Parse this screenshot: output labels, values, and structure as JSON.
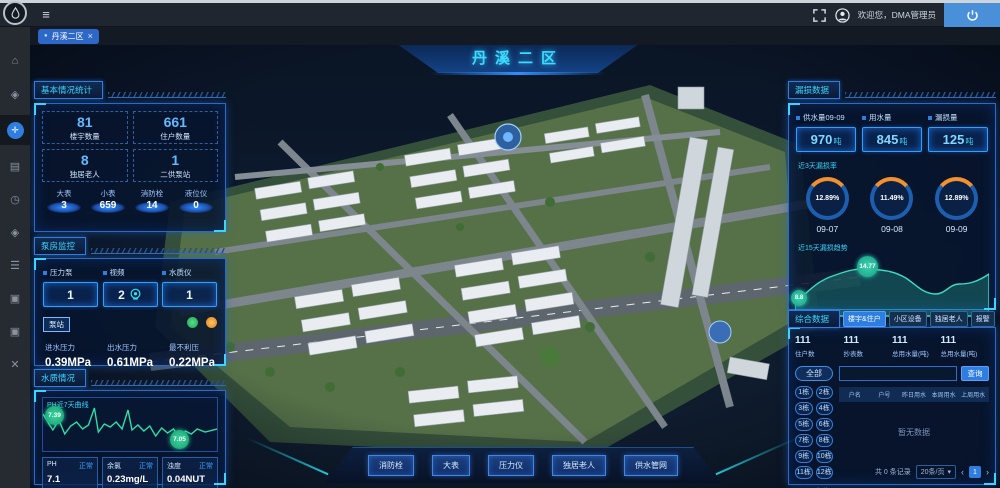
{
  "topbar": {
    "welcome": "欢迎您，DMA管理员",
    "hamburger_glyph": "≡"
  },
  "tab": {
    "dot": "●",
    "label": "丹溪二区",
    "close": "×"
  },
  "sidebar": {
    "icons": [
      {
        "name": "home",
        "glyph": "⌂"
      },
      {
        "name": "water-drop",
        "glyph": "◈"
      },
      {
        "name": "dashboard-active",
        "glyph": "✛"
      },
      {
        "name": "chart",
        "glyph": "▤"
      },
      {
        "name": "history-clock",
        "glyph": "◷"
      },
      {
        "name": "water-quality",
        "glyph": "◈"
      },
      {
        "name": "list",
        "glyph": "☰"
      },
      {
        "name": "monitor",
        "glyph": "▣"
      },
      {
        "name": "screen",
        "glyph": "▣"
      },
      {
        "name": "tools",
        "glyph": "✕"
      }
    ]
  },
  "main": {
    "title": "丹溪二区"
  },
  "stats_panel": {
    "title": "基本情况统计",
    "cells": [
      {
        "value": "81",
        "label": "楼宇数量"
      },
      {
        "value": "661",
        "label": "住户数量"
      },
      {
        "value": "8",
        "label": "独居老人"
      },
      {
        "value": "1",
        "label": "二供泵站"
      }
    ],
    "pedestals": [
      {
        "label": "大表",
        "value": "3"
      },
      {
        "label": "小表",
        "value": "659"
      },
      {
        "label": "消防栓",
        "value": "14"
      },
      {
        "label": "液位仪",
        "value": "0"
      }
    ]
  },
  "pump_panel": {
    "title": "泵房监控",
    "items": [
      {
        "label": "压力泵",
        "value": "1"
      },
      {
        "label": "视频",
        "value": "2"
      },
      {
        "label": "水质仪",
        "value": "1"
      }
    ],
    "station_tag": "泵站",
    "metrics": [
      {
        "label": "进水压力",
        "value": "0.39MPa"
      },
      {
        "label": "出水压力",
        "value": "0.61MPa"
      },
      {
        "label": "最不利压",
        "value": "0.22MPa"
      }
    ]
  },
  "quality_panel": {
    "title": "水质情况",
    "chart_title": "PH近7天曲线",
    "bubble_start": "7.39",
    "bubble_end": "7.05",
    "cards": [
      {
        "label": "PH",
        "status": "正常",
        "value": "7.1"
      },
      {
        "label": "余氯",
        "status": "正常",
        "value": "0.23mg/L"
      },
      {
        "label": "浊度",
        "status": "正常",
        "value": "0.04NUT"
      }
    ]
  },
  "leak_panel": {
    "title": "漏损数据",
    "stats": [
      {
        "label": "供水量09-09",
        "value": "970",
        "unit": "吨"
      },
      {
        "label": "用水量",
        "value": "845",
        "unit": "吨"
      },
      {
        "label": "漏损量",
        "value": "125",
        "unit": "吨"
      }
    ],
    "donut_title": "近3天漏损率",
    "donuts": [
      {
        "pct": "12.89%",
        "date": "09-07"
      },
      {
        "pct": "11.49%",
        "date": "09-08"
      },
      {
        "pct": "12.89%",
        "date": "09-09"
      }
    ],
    "trend_title": "近15天漏损趋势",
    "trend_bubble_start": "8.8",
    "trend_bubble_peak": "14.77"
  },
  "data_panel": {
    "title": "综合数据",
    "tabs": [
      {
        "label": "楼宇&住户"
      },
      {
        "label": "小区设备"
      },
      {
        "label": "独居老人"
      },
      {
        "label": "报警"
      }
    ],
    "stats": [
      {
        "value": "111",
        "label": "住户数"
      },
      {
        "value": "111",
        "label": "抄表数"
      },
      {
        "value": "111",
        "label": "总用水量(吨)"
      },
      {
        "value": "111",
        "label": "总用水量(吨)"
      }
    ],
    "all_button": "全部",
    "buildings": [
      "1栋",
      "2栋",
      "3栋",
      "4栋",
      "5栋",
      "6栋",
      "7栋",
      "8栋",
      "9栋",
      "10栋",
      "11栋",
      "12栋"
    ],
    "toggle_label": "定位开启",
    "search": {
      "button": "查询"
    },
    "table": {
      "headers": [
        "户名",
        "户号",
        "昨日用水",
        "本周用水",
        "上周用水"
      ],
      "empty": "暂无数据"
    },
    "footer": {
      "total": "共 0 条记录",
      "page_size": "20条/页",
      "caret": "▾",
      "prev": "‹",
      "page": "1",
      "next": "›"
    }
  },
  "bottom_buttons": [
    "消防栓",
    "大表",
    "压力仪",
    "独居老人",
    "供水管网"
  ],
  "chart_data": [
    {
      "type": "line",
      "title": "PH近7天曲线",
      "series": [
        {
          "name": "PH",
          "values": [
            7.39,
            7.2,
            7.1,
            7.32,
            7.15,
            7.28,
            7.05
          ]
        }
      ],
      "annotations": [
        "7.39",
        "7.05"
      ]
    },
    {
      "type": "area",
      "title": "近15天漏损趋势",
      "values": [
        8.8,
        10.5,
        12.2,
        13.6,
        14.77,
        14.3,
        14.1,
        13.2,
        11.8,
        11.2,
        11.6,
        12.4,
        12.1,
        11.7,
        12.89
      ]
    },
    {
      "type": "donut",
      "title": "近3天漏损率",
      "categories": [
        "09-07",
        "09-08",
        "09-09"
      ],
      "values": [
        12.89,
        11.49,
        12.89
      ]
    }
  ]
}
